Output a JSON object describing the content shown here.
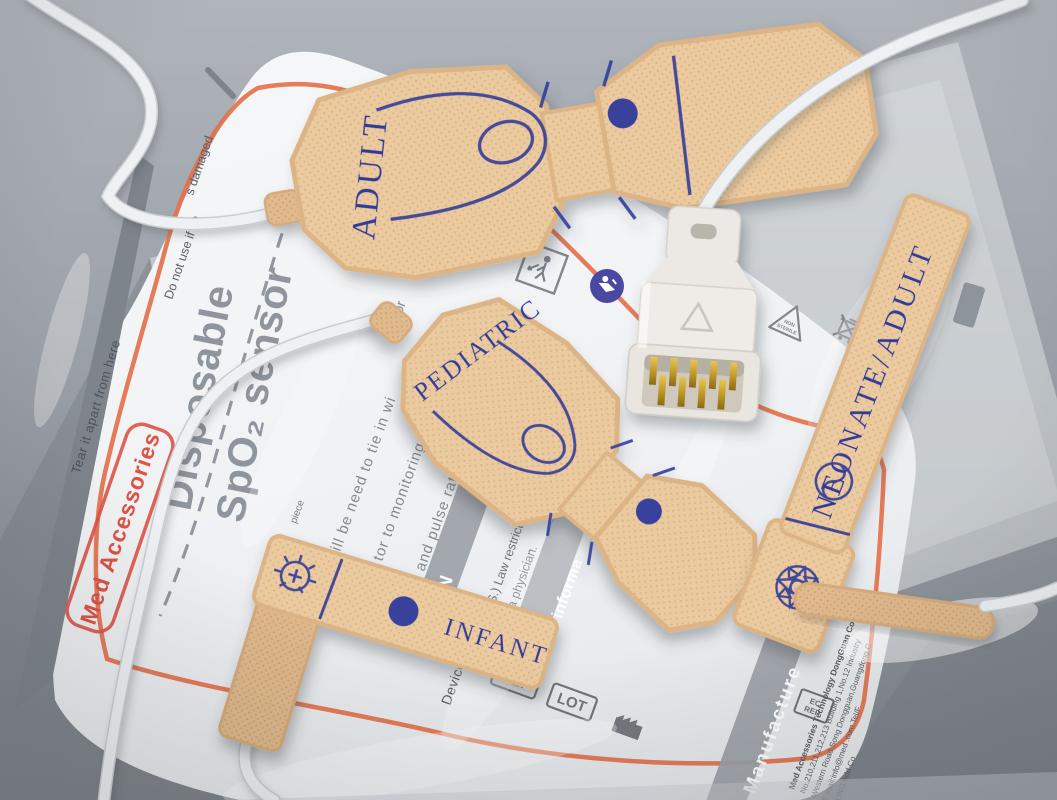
{
  "colors": {
    "table_gray": "#9aa0a7",
    "pouch_white": "#f4f5f7",
    "accent_orange": "#e4714b",
    "logo_red": "#dd5346",
    "print_navy": "#2e3a9a",
    "fabric_tan": "#ecca9f",
    "print_gray": "#868c94",
    "cable_white": "#eef1f4"
  },
  "package": {
    "brand": "Med Accessories",
    "title_line1": "Disposable",
    "title_line2": "SpO₂ sensor",
    "tear_text": "Tear it apart from here",
    "warning_fragment_1": "Do not use if pa",
    "warning_fragment_2": "s damaged",
    "instructions": {
      "line1": "ill be need to tie in wi",
      "line2": "tor to monitoring oxy",
      "line3": "and pulse rate for ne",
      "frag_er_or": "er or",
      "frag_on": "on",
      "frag_piece": "piece"
    },
    "caution": {
      "bar_label": "ION",
      "law_line1": "(U.S.) Law restricts th",
      "law_line2": "er of a physician."
    },
    "product_info_bar": "uct informa",
    "device_name_label": "Device name:",
    "manufacture_bar": "Manufacture",
    "manufacturer": {
      "line1": "Med Accessories Technology DongGuan Co.,Ltd.",
      "line2": "No.210,211,212,213  Building 1,No.12 Industry",
      "line3": "Western Road,Song  Dongguan,Guangdong,C",
      "line4": "E-mail:info@med  .com  Tel/F",
      "line5": "SUNG  Add  Co"
    },
    "symbols": {
      "ref": "REF",
      "lot": "LOT",
      "ec": "EC",
      "rep": "REP",
      "non": "NON",
      "sterile": "STERILE"
    }
  },
  "sensors": {
    "adult": "ADULT",
    "pediatric": "PEDIATRIC",
    "infant": "INFANT",
    "neonate": "NEONATE/ADULT"
  }
}
